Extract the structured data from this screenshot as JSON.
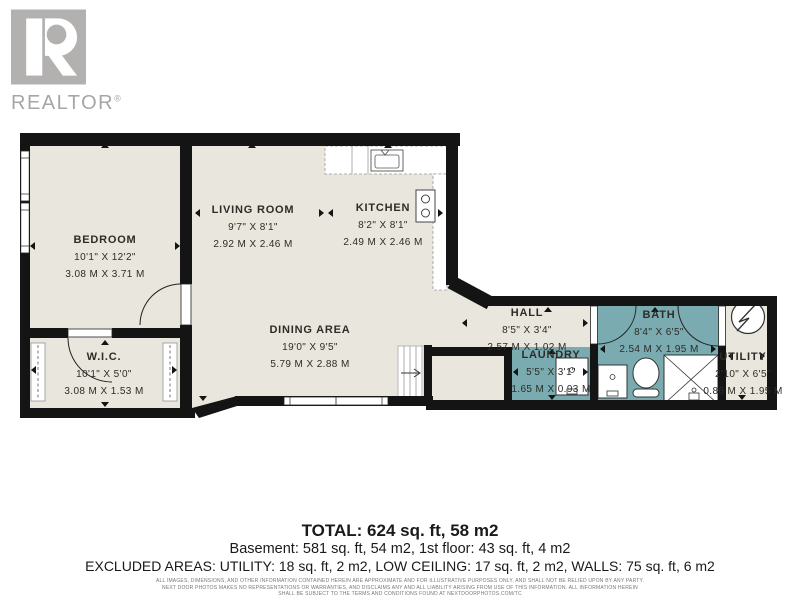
{
  "branding": {
    "logo_text": "REALTOR",
    "registered_mark": "®"
  },
  "rooms": {
    "bedroom": {
      "name": "BEDROOM",
      "imperial": "10'1\" X 12'2\"",
      "metric": "3.08 M X 3.71 M"
    },
    "living": {
      "name": "LIVING ROOM",
      "imperial": "9'7\" X 8'1\"",
      "metric": "2.92 M X 2.46 M"
    },
    "kitchen": {
      "name": "KITCHEN",
      "imperial": "8'2\" X 8'1\"",
      "metric": "2.49 M X 2.46 M"
    },
    "dining": {
      "name": "DINING AREA",
      "imperial": "19'0\" X 9'5\"",
      "metric": "5.79 M X 2.88 M"
    },
    "wic": {
      "name": "W.I.C.",
      "imperial": "10'1\" X 5'0\"",
      "metric": "3.08 M X 1.53 M"
    },
    "hall": {
      "name": "HALL",
      "imperial": "8'5\" X 3'4\"",
      "metric": "2.57 M X 1.02 M"
    },
    "laundry": {
      "name": "LAUNDRY",
      "imperial": "5'5\" X 3'1\"",
      "metric": "1.65 M X 0.93 M"
    },
    "bath": {
      "name": "BATH",
      "imperial": "8'4\" X 6'5\"",
      "metric": "2.54 M X 1.95 M"
    },
    "utility": {
      "name": "UTILITY",
      "imperial": "2'10\" X 6'5\"",
      "metric": "0.86 M X 1.95 M"
    }
  },
  "summary": {
    "total": "TOTAL: 624 sq. ft, 58 m2",
    "floors": "Basement: 581 sq. ft, 54 m2, 1st floor: 43 sq. ft, 4 m2",
    "excluded": "EXCLUDED AREAS: UTILITY: 18 sq. ft, 2 m2, LOW CEILING: 17 sq. ft, 2 m2, WALLS: 75 sq. ft, 6 m2"
  },
  "disclaimer": {
    "line1": "ALL IMAGES, DIMENSIONS, AND OTHER INFORMATION CONTAINED HEREIN ARE APPROXIMATE AND FOR ILLUSTRATIVE PURPOSES ONLY, AND SHALL NOT BE RELIED UPON BY ANY PARTY.",
    "line2": "NEXT DOOR PHOTOS MAKES NO REPRESENTATIONS OR WARRANTIES, AND DISCLAIMS ANY AND ALL LIABILITY ARISING FROM USE OF THIS INFORMATION. ALL INFORMATION HEREIN",
    "line3": "SHALL BE SUBJECT TO THE TERMS AND CONDITIONS FOUND AT NEXTDOORPHOTOS.COM/TC"
  },
  "colors": {
    "floor": "#e9e6dd",
    "wet_room": "#7aabb1",
    "wall": "#141414",
    "logo_gray": "#b3b0b0"
  }
}
